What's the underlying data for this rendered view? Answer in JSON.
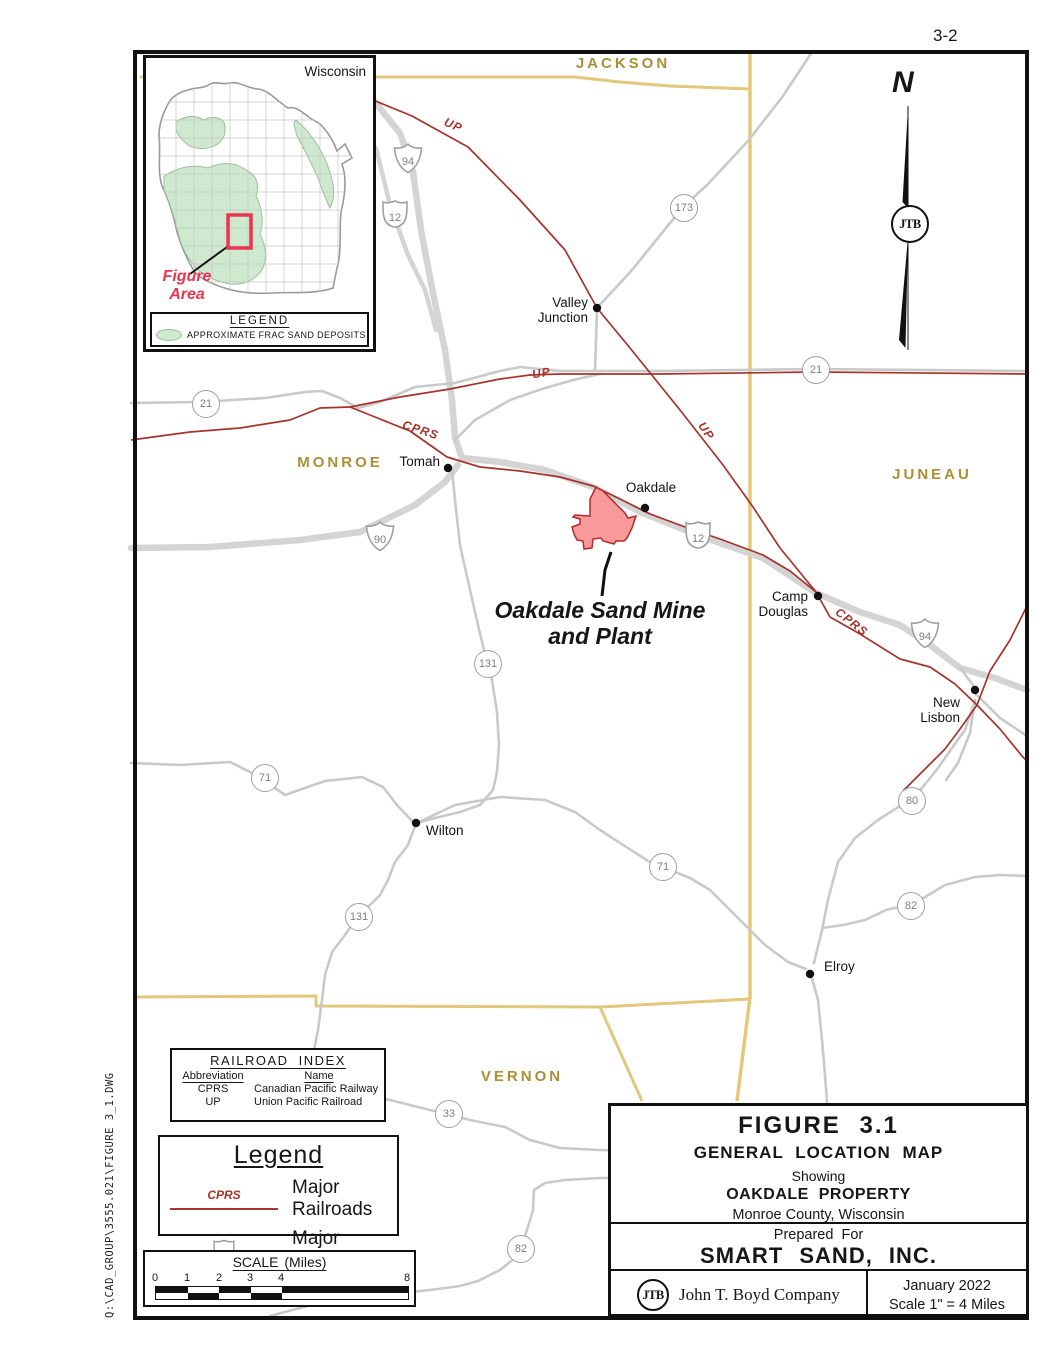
{
  "page": {
    "number": "3-2",
    "file_path": "Q:\\CAD_GROUP\\3555.021\\FIGURE 3_1.DWG"
  },
  "inset": {
    "title": "Wisconsin",
    "figure_area_label": "Figure\nArea",
    "legend_title": "LEGEND",
    "legend_item": "APPROXIMATE FRAC SAND DEPOSITS"
  },
  "compass": {
    "north_label": "N",
    "logo": "JTB"
  },
  "map": {
    "counties": [
      "JACKSON",
      "MONROE",
      "JUNEAU",
      "VERNON"
    ],
    "towns": [
      {
        "name": "Valley\nJunction"
      },
      {
        "name": "Tomah"
      },
      {
        "name": "Oakdale"
      },
      {
        "name": "Camp\nDouglas"
      },
      {
        "name": "New\nLisbon"
      },
      {
        "name": "Wilton"
      },
      {
        "name": "Elroy"
      }
    ],
    "railroad_labels": [
      "UP",
      "UP",
      "UP",
      "CPRS",
      "CPRS"
    ],
    "shields": [
      {
        "type": "interstate",
        "label": "94"
      },
      {
        "type": "us",
        "label": "12"
      },
      {
        "type": "state",
        "label": "173"
      },
      {
        "type": "state",
        "label": "21"
      },
      {
        "type": "state",
        "label": "21"
      },
      {
        "type": "interstate",
        "label": "90"
      },
      {
        "type": "us",
        "label": "12"
      },
      {
        "type": "interstate",
        "label": "94"
      },
      {
        "type": "state",
        "label": "131"
      },
      {
        "type": "state",
        "label": "71"
      },
      {
        "type": "state",
        "label": "131"
      },
      {
        "type": "state",
        "label": "71"
      },
      {
        "type": "state",
        "label": "80"
      },
      {
        "type": "state",
        "label": "82"
      },
      {
        "type": "state",
        "label": "33"
      },
      {
        "type": "state",
        "label": "82"
      }
    ],
    "mine_label": "Oakdale Sand Mine\nand Plant"
  },
  "railroad_index": {
    "title": "RAILROAD INDEX",
    "col_abbreviation": "Abbreviation",
    "col_name": "Name",
    "rows": [
      {
        "abbr": "CPRS",
        "name": "Canadian Pacific Railway"
      },
      {
        "abbr": "UP",
        "name": "Union Pacific Railroad"
      }
    ]
  },
  "legend": {
    "title": "Legend",
    "railroad_symbol_text": "CPRS",
    "railroad_label": "Major Railroads",
    "road_symbol_shield": "94",
    "road_label": "Major Roads"
  },
  "scale_bar": {
    "title": "SCALE (Miles)",
    "ticks": [
      "0",
      "1",
      "2",
      "3",
      "4",
      "8"
    ]
  },
  "title_block": {
    "figure": "FIGURE 3.1",
    "title": "GENERAL LOCATION MAP",
    "showing": "Showing",
    "property": "OAKDALE PROPERTY",
    "location": "Monroe County, Wisconsin",
    "prepared_for": "Prepared For",
    "client": "SMART SAND, INC.",
    "logo": "JTB",
    "company": "John T. Boyd Company",
    "date": "January 2022",
    "scale": "Scale 1\" =  4 Miles"
  },
  "colors": {
    "county_label": "#ab8f35",
    "county_line": "#e3c87c",
    "railroad": "#a6332c",
    "road": "#c9c9c9",
    "mine_fill": "#f89a9a",
    "mine_outline": "#b22a2a",
    "figure_area_accent": "#e8364e",
    "frac_sand_deposit": "#cfe9cf"
  }
}
